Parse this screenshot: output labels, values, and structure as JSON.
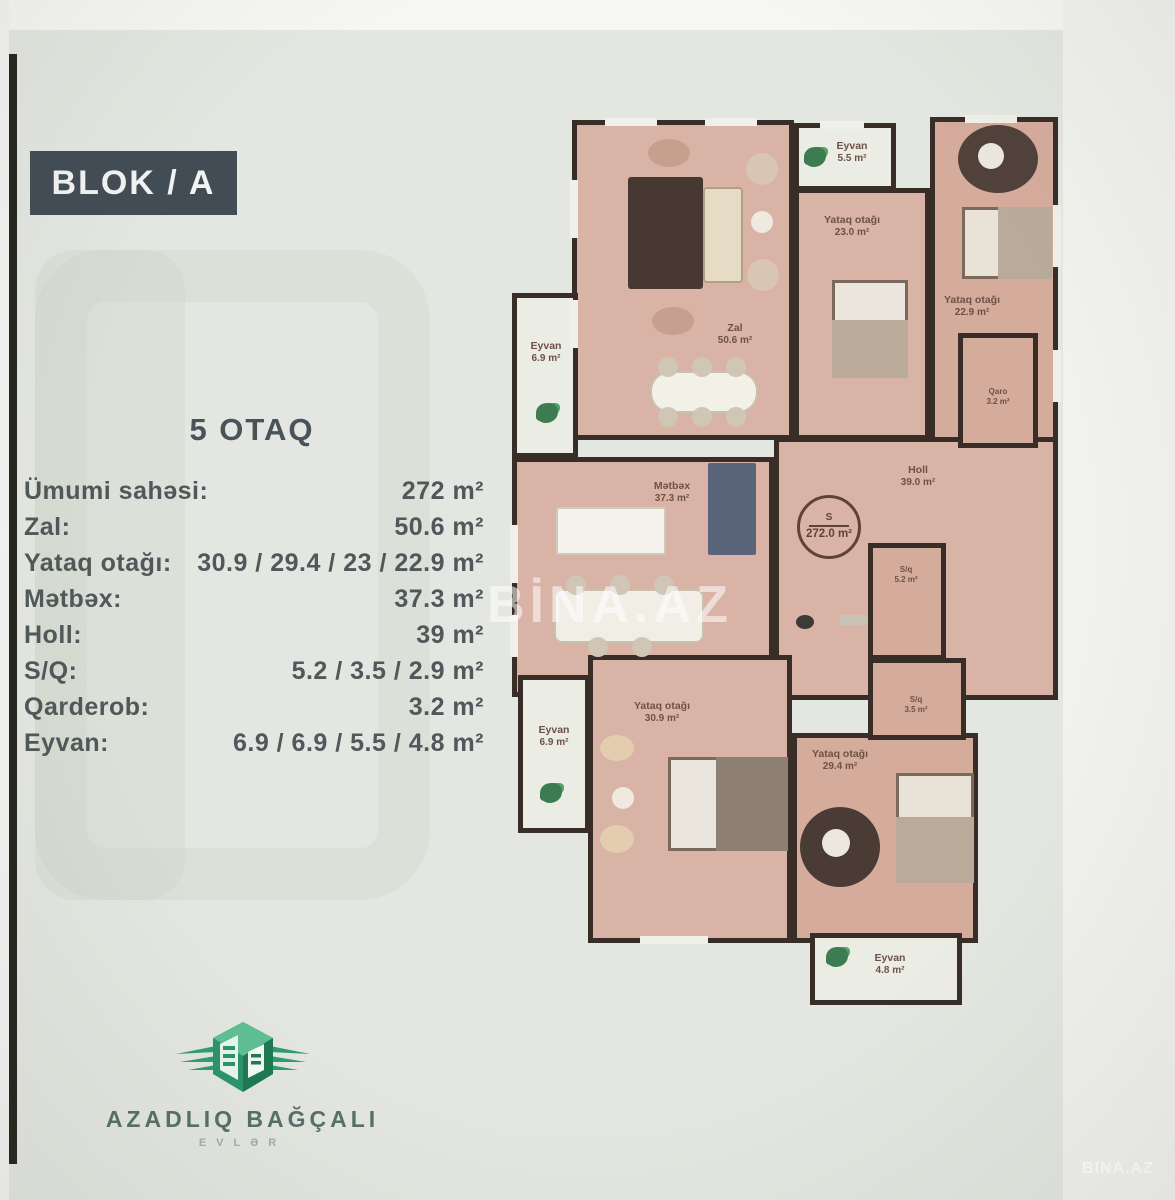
{
  "page": {
    "block_label": "BLOK / A",
    "title": "5 OTAQ",
    "watermark_center": "BİNA.AZ",
    "watermark_corner": "BINA.AZ"
  },
  "specs": {
    "rows": [
      {
        "label": "Ümumi sahəsi:",
        "value": "272 m²"
      },
      {
        "label": "Zal:",
        "value": "50.6 m²"
      },
      {
        "label": "Yataq otağı:",
        "value": "30.9 / 29.4 / 23 / 22.9 m²"
      },
      {
        "label": "Mətbəx:",
        "value": "37.3 m²"
      },
      {
        "label": "Holl:",
        "value": "39 m²"
      },
      {
        "label": "S/Q:",
        "value": "5.2 / 3.5 / 2.9 m²"
      },
      {
        "label": "Qarderob:",
        "value": "3.2 m²"
      },
      {
        "label": "Eyvan:",
        "value": "6.9 / 6.9 / 5.5 / 4.8 m²"
      }
    ]
  },
  "floorplan": {
    "stamp": {
      "s_label": "S",
      "total_area": "272.0 m²"
    },
    "rooms": {
      "zal": {
        "name": "Zal",
        "area": "50.6 m²"
      },
      "eyvan_top": {
        "name": "Eyvan",
        "area": "5.5 m²"
      },
      "yataq1": {
        "name": "Yataq otağı",
        "area": "23.0 m²"
      },
      "yataq2": {
        "name": "Yataq otağı",
        "area": "22.9 m²"
      },
      "eyvan_left": {
        "name": "Eyvan",
        "area": "6.9 m²"
      },
      "metbex": {
        "name": "Mətbəx",
        "area": "37.3 m²"
      },
      "holl": {
        "name": "Holl",
        "area": "39.0 m²"
      },
      "qarderob": {
        "name": "Qaro",
        "area": "3.2 m²"
      },
      "sq1": {
        "name": "S/q",
        "area": "5.2 m²"
      },
      "sq2": {
        "name": "S/q",
        "area": "3.5 m²"
      },
      "yataq3": {
        "name": "Yataq otağı",
        "area": "30.9 m²"
      },
      "eyvan_bl": {
        "name": "Eyvan",
        "area": "6.9 m²"
      },
      "yataq4": {
        "name": "Yataq otağı",
        "area": "29.4 m²"
      },
      "eyvan_bottom": {
        "name": "Eyvan",
        "area": "4.8 m²"
      }
    },
    "colors": {
      "floor": "#d9b3a5",
      "wall": "#382e27",
      "balcony": "#ebece4",
      "label_text": "#6e5146"
    }
  },
  "logo": {
    "brand": "AZADLIQ BAĞÇALI",
    "sub": "EVLƏR",
    "accent_green": "#2f9d6f"
  }
}
